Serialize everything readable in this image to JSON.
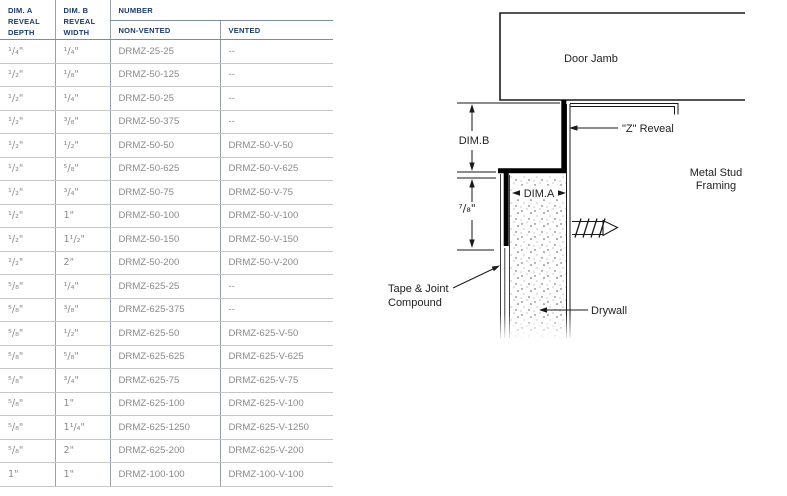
{
  "colors": {
    "header_text": "#1b3a6b",
    "body_text": "#8a8a8a",
    "header_rule": "#7e8ba1",
    "row_rule": "#c6c6c6",
    "column_rule": "#9aa0a8",
    "diagram_line": "#1a1a1a"
  },
  "table": {
    "headers": {
      "dim_a": "DIM. A REVEAL DEPTH",
      "dim_b": "DIM. B REVEAL WIDTH",
      "number": "NUMBER",
      "non_vented": "NON-VENTED",
      "vented": "VENTED"
    },
    "rows": [
      {
        "a": "¹/₄\"",
        "b": "¹/₄\"",
        "nv": "DRMZ-25-25",
        "v": "--"
      },
      {
        "a": "¹/₂\"",
        "b": "¹/₈\"",
        "nv": "DRMZ-50-125",
        "v": "--"
      },
      {
        "a": "¹/₂\"",
        "b": "¹/₄\"",
        "nv": "DRMZ-50-25",
        "v": "--"
      },
      {
        "a": "¹/₂\"",
        "b": "³/₈\"",
        "nv": "DRMZ-50-375",
        "v": "--"
      },
      {
        "a": "¹/₂\"",
        "b": "¹/₂\"",
        "nv": "DRMZ-50-50",
        "v": "DRMZ-50-V-50"
      },
      {
        "a": "¹/₂\"",
        "b": "⁵/₈\"",
        "nv": "DRMZ-50-625",
        "v": "DRMZ-50-V-625"
      },
      {
        "a": "¹/₂\"",
        "b": "³/₄\"",
        "nv": "DRMZ-50-75",
        "v": "DRMZ-50-V-75"
      },
      {
        "a": "¹/₂\"",
        "b": "1\"",
        "nv": "DRMZ-50-100",
        "v": "DRMZ-50-V-100"
      },
      {
        "a": "¹/₂\"",
        "b": "1¹/₂\"",
        "nv": "DRMZ-50-150",
        "v": "DRMZ-50-V-150"
      },
      {
        "a": "¹/₂\"",
        "b": "2\"",
        "nv": "DRMZ-50-200",
        "v": "DRMZ-50-V-200"
      },
      {
        "a": "⁵/₈\"",
        "b": "¹/₄\"",
        "nv": "DRMZ-625-25",
        "v": "--"
      },
      {
        "a": "⁵/₈\"",
        "b": "³/₈\"",
        "nv": "DRMZ-625-375",
        "v": "--"
      },
      {
        "a": "⁵/₈\"",
        "b": "¹/₂\"",
        "nv": "DRMZ-625-50",
        "v": "DRMZ-625-V-50"
      },
      {
        "a": "⁵/₈\"",
        "b": "⁵/₈\"",
        "nv": "DRMZ-625-625",
        "v": "DRMZ-625-V-625"
      },
      {
        "a": "⁵/₈\"",
        "b": "³/₄\"",
        "nv": "DRMZ-625-75",
        "v": "DRMZ-625-V-75"
      },
      {
        "a": "⁵/₈\"",
        "b": "1\"",
        "nv": "DRMZ-625-100",
        "v": "DRMZ-625-V-100"
      },
      {
        "a": "⁵/₈\"",
        "b": "1¹/₄\"",
        "nv": "DRMZ-625-1250",
        "v": "DRMZ-625-V-1250"
      },
      {
        "a": "⁵/₈\"",
        "b": "2\"",
        "nv": "DRMZ-625-200",
        "v": "DRMZ-625-V-200"
      },
      {
        "a": "1\"",
        "b": "1\"",
        "nv": "DRMZ-100-100",
        "v": "DRMZ-100-V-100"
      }
    ]
  },
  "diagram": {
    "labels": {
      "door_jamb": "Door Jamb",
      "dim_b": "DIM.B",
      "dim_a": "DIM.A",
      "z_reveal": "\"Z\" Reveal",
      "flange_height": "⁷/₈\"",
      "metal_stud_1": "Metal Stud",
      "metal_stud_2": "Framing",
      "tape_1": "Tape & Joint",
      "tape_2": "Compound",
      "drywall": "Drywall"
    }
  }
}
